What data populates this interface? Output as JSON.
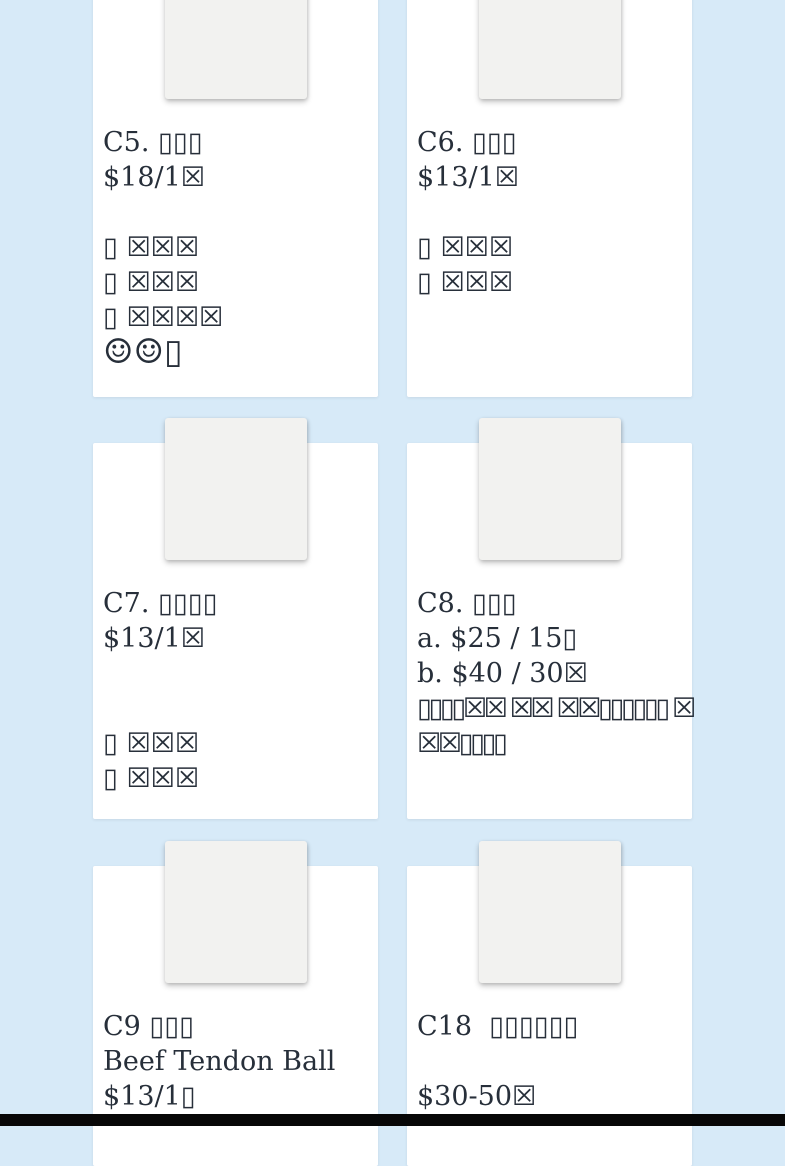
{
  "page": {
    "background_color": "#d7eaf8",
    "card_color": "#ffffff",
    "photo_placeholder_color": "#f2f2f0",
    "text_color": "#272f3a",
    "bottom_bar_color": "#070707"
  },
  "cards": [
    {
      "id": "C5",
      "title": "C5. ▯▯▯",
      "lines": [
        {
          "kind": "price",
          "text": "$18/1☒"
        },
        {
          "kind": "blank",
          "text": ""
        },
        {
          "kind": "desc",
          "text": "▯ ☒☒☒"
        },
        {
          "kind": "desc",
          "text": "▯ ☒☒☒"
        },
        {
          "kind": "desc",
          "text": "▯ ☒☒☒☒"
        },
        {
          "kind": "emoji",
          "text": "☺☺▯"
        }
      ]
    },
    {
      "id": "C6",
      "title": "C6. ▯▯▯",
      "lines": [
        {
          "kind": "price",
          "text": "$13/1☒"
        },
        {
          "kind": "blank",
          "text": ""
        },
        {
          "kind": "desc",
          "text": "▯ ☒☒☒"
        },
        {
          "kind": "desc",
          "text": "▯ ☒☒☒"
        }
      ]
    },
    {
      "id": "C7",
      "title": "C7. ▯▯▯▯",
      "lines": [
        {
          "kind": "price",
          "text": "$13/1☒"
        },
        {
          "kind": "blank",
          "text": ""
        },
        {
          "kind": "blank",
          "text": ""
        },
        {
          "kind": "desc",
          "text": "▯ ☒☒☒"
        },
        {
          "kind": "desc",
          "text": "▯ ☒☒☒"
        }
      ]
    },
    {
      "id": "C8",
      "title": "C8. ▯▯▯",
      "lines": [
        {
          "kind": "price",
          "text": "a. $25 / 15▯"
        },
        {
          "kind": "price",
          "text": "b. $40 / 30☒"
        },
        {
          "kind": "desc-tight",
          "text": "▯▯▯▯☒☒ ☒☒ ☒☒▯▯▯▯▯▯ ☒"
        },
        {
          "kind": "desc-tight",
          "text": "☒☒▯▯▯▯"
        }
      ]
    },
    {
      "id": "C9",
      "title": "C9 ▯▯▯",
      "lines": [
        {
          "kind": "name",
          "text": "Beef Tendon Ball"
        },
        {
          "kind": "price",
          "text": "$13/1▯"
        }
      ]
    },
    {
      "id": "C18",
      "title": "C18  ▯▯▯▯▯▯",
      "lines": [
        {
          "kind": "blank",
          "text": ""
        },
        {
          "kind": "price",
          "text": "$30-50☒"
        }
      ]
    }
  ]
}
